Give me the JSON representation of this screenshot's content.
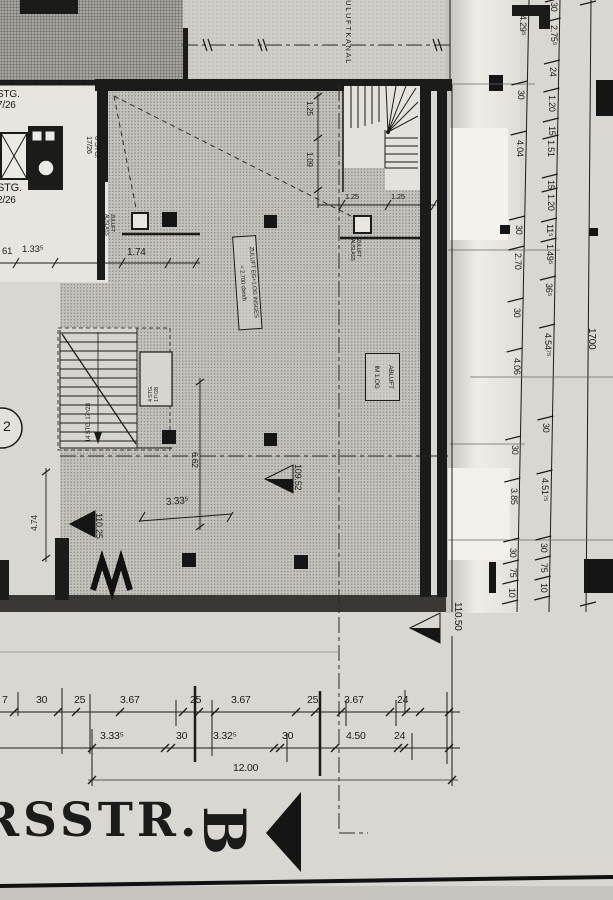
{
  "palette": {
    "paper": "#d9d7d1",
    "ink": "#1b1b1a",
    "texture_dark": "#a7a5a0",
    "texture_mid": "#c4c2bc",
    "band_dark": "#393835"
  },
  "drawing": {
    "duct_label": "ZULUFTKANAL",
    "stair_core": {
      "upper_line1": "STG.",
      "upper_line2": "7/26",
      "mid_line1": "6 STG.",
      "mid_line2": "17/26",
      "lower_line1": "STG.",
      "lower_line2": "2/26"
    },
    "supply_note": {
      "line1": "ZULUFT EG+1.OG INSGES",
      "line2": "= 2.700 cbm/h"
    },
    "exhaust_note": {
      "line1": "ABLUFT",
      "line2": "IM 1.OG"
    },
    "vent_left": {
      "line1": "ZULUFT",
      "line2": "AUSLASS"
    },
    "vent_right": {
      "line1": "ZULUFT",
      "line2": "AUSLASS"
    },
    "stair_main_label": "14 STG. 17⁵/28",
    "stair_box_label": {
      "line1": "4 STG.",
      "line2": "17⁵/28"
    },
    "grid_bubble": "2",
    "street_name": "RSSTR.",
    "section_letter": "B",
    "levels": {
      "left": "110.25",
      "center": "109.52",
      "right": "110.50"
    }
  },
  "dimensions": {
    "near_core": {
      "a": "61",
      "b": "1.33⁵",
      "c": "1.74"
    },
    "stair_top": {
      "v1": "1.25",
      "v2": "1.09",
      "h1": "1.25",
      "h2": "1.25"
    },
    "interior": {
      "width": "6.62",
      "depth": "3.33⁵",
      "left": "4.74"
    },
    "right_chain_inner": [
      "4.29⁵",
      "30",
      "4.04",
      "30",
      "2.70",
      "30",
      "4.06",
      "30",
      "3.85",
      "30",
      "75",
      "10"
    ],
    "right_chain_outer": [
      "30",
      "2.75⁵",
      "24",
      "1.20",
      "15",
      "1.51",
      "15",
      "1.20",
      "11⁵",
      "1.49⁵",
      "36⁵",
      "4.54⁷⁵",
      "30",
      "4.51⁷⁵",
      "30",
      "75",
      "10"
    ],
    "right_overall": "1700",
    "bottom_row1": [
      "7",
      "30",
      "25",
      "3.67",
      "25",
      "3.67",
      "25",
      "3.67",
      "24"
    ],
    "bottom_row2": [
      "3.33⁵",
      "30",
      "3.32⁵",
      "30",
      "4.50",
      "24"
    ],
    "bottom_row3": [
      "12.00"
    ]
  }
}
